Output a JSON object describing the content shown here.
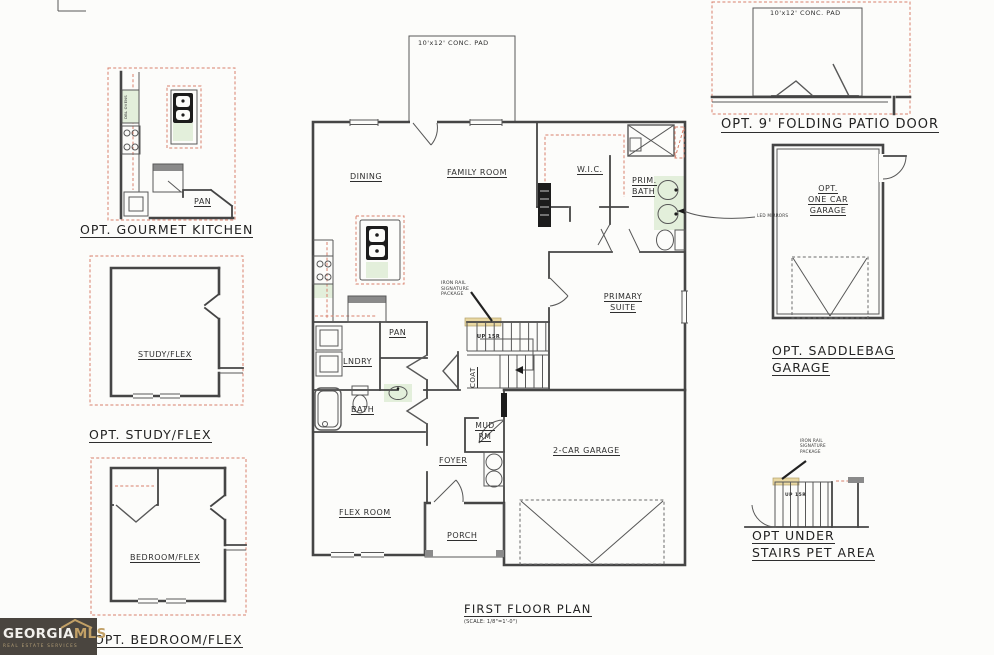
{
  "drawing": {
    "title": "FIRST FLOOR PLAN",
    "scale_note": "(SCALE: 1/8\"=1'-0\")",
    "conc_pad_label": "10'x12' CONC. PAD",
    "rooms": {
      "dining": "DINING",
      "family_room": "FAMILY ROOM",
      "wic": "W.I.C.",
      "prim_bath_line1": "PRIM.",
      "prim_bath_line2": "BATH",
      "primary_suite_line1": "PRIMARY",
      "primary_suite_line2": "SUITE",
      "pan": "PAN",
      "lndry": "LNDRY",
      "bath": "BATH",
      "coat": "COAT",
      "mud_rm_line1": "MUD",
      "mud_rm_line2": "RM",
      "foyer": "FOYER",
      "flex_room": "FLEX ROOM",
      "porch": "PORCH",
      "garage": "2-CAR GARAGE"
    },
    "stairs_label": "UP 15R",
    "callouts": {
      "iron_rail_line1": "IRON RAIL",
      "iron_rail_line2": "SIGNATURE",
      "iron_rail_line3": "PACKAGE",
      "led_mirrors": "LED MIRRORS"
    }
  },
  "options": {
    "gourmet_kitchen": {
      "caption": "OPT. GOURMET KITCHEN",
      "pan": "PAN",
      "dbl_ovens": "DBL OVENS"
    },
    "study_flex": {
      "caption": "OPT. STUDY/FLEX",
      "room": "STUDY/FLEX"
    },
    "bedroom_flex": {
      "caption": "OPT. BEDROOM/FLEX",
      "room": "BEDROOM/FLEX"
    },
    "patio_door": {
      "caption": "OPT. 9' FOLDING PATIO DOOR",
      "pad_label": "10'x12' CONC. PAD"
    },
    "saddlebag_garage": {
      "caption_line1": "OPT. SADDLEBAG",
      "caption_line2": "GARAGE",
      "room_line1": "OPT.",
      "room_line2": "ONE CAR",
      "room_line3": "GARAGE"
    },
    "pet_area": {
      "caption_line1": "OPT UNDER",
      "caption_line2": "STAIRS PET AREA",
      "stairs_label": "UP 15R",
      "callout_line1": "IRON RAIL",
      "callout_line2": "SIGNATURE",
      "callout_line3": "PACKAGE"
    }
  },
  "logo": {
    "brand_primary": "GEORGIA",
    "brand_accent": "MLS",
    "tagline": "REAL ESTATE SERVICES"
  },
  "colors": {
    "line": "#454545",
    "dashed_accent": "#d9806c",
    "tint_green": "#e3efdb",
    "tint_tan": "#e9d8a2",
    "logo_bg": "#4a453f",
    "logo_gold": "#c2a066"
  }
}
